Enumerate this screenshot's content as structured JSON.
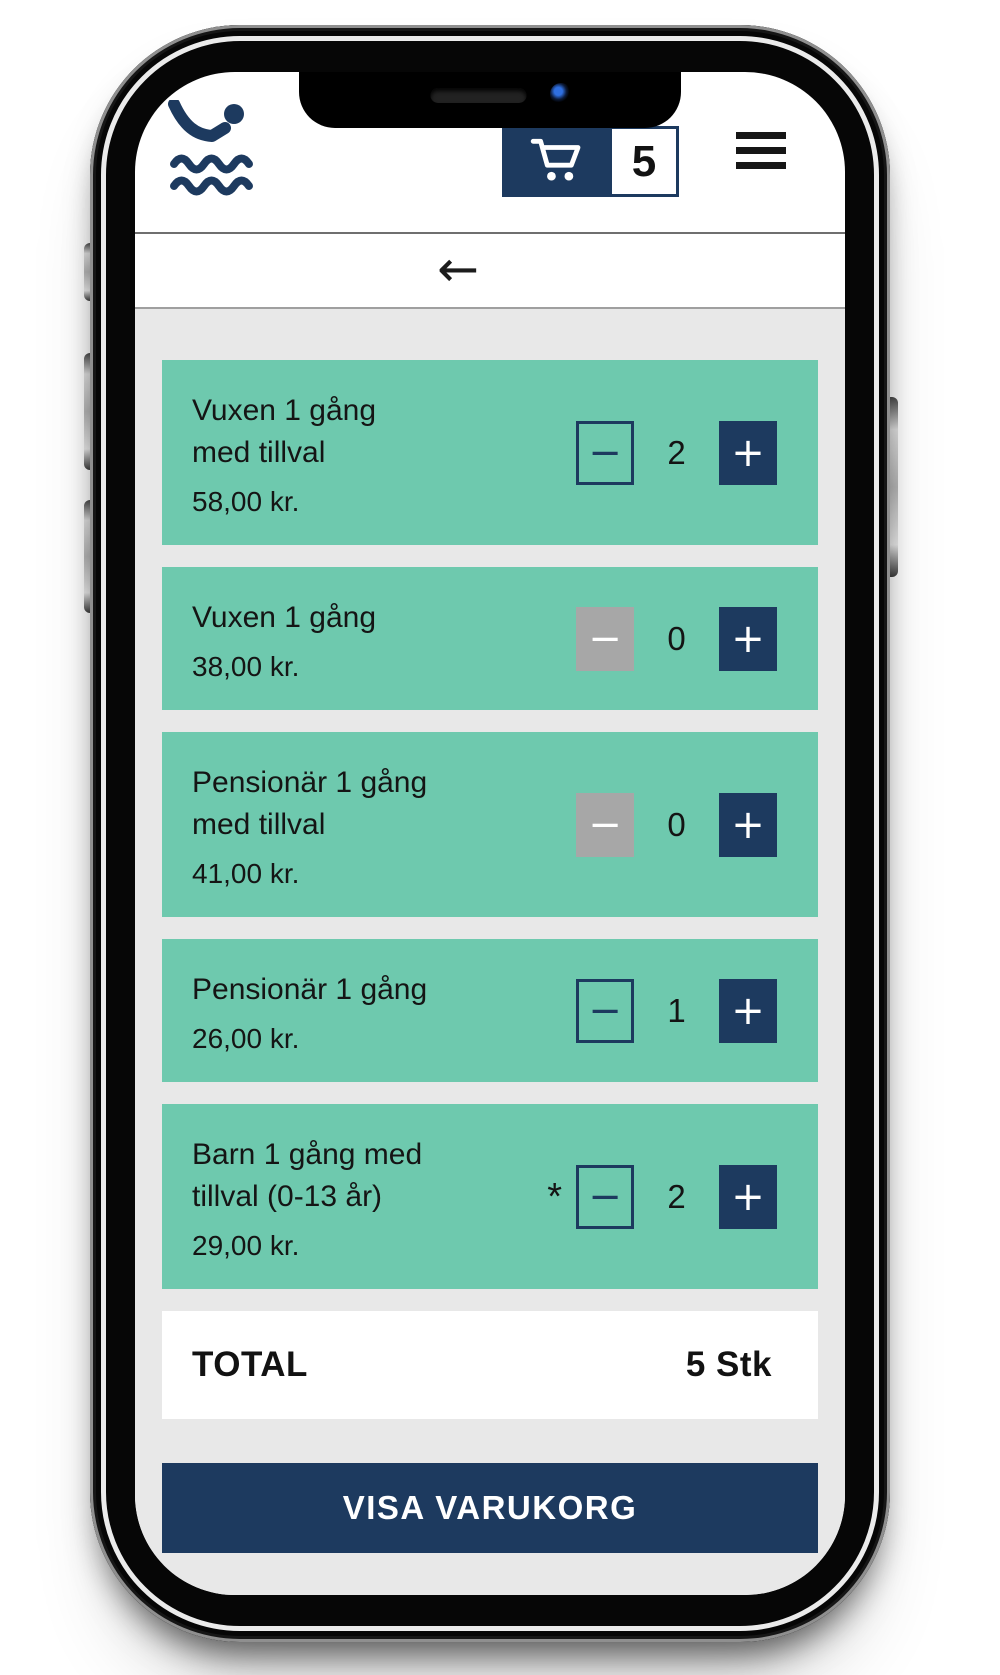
{
  "colors": {
    "navy": "#1d3a5f",
    "teal": "#6ec9ae",
    "screen_bg": "#e8e8e8",
    "disabled_gray": "#a7a7a7"
  },
  "icons": {
    "logo": "swimmer-waves-icon",
    "cart": "cart-icon",
    "menu": "hamburger-icon",
    "back": "back-arrow-icon"
  },
  "header": {
    "cart_count": "5"
  },
  "nav": {
    "back": "←"
  },
  "symbols": {
    "minus": "−",
    "plus": "+"
  },
  "tickets": [
    {
      "title": "Vuxen 1 gång med tillval",
      "price": "58,00 kr.",
      "qty": "2",
      "minus_state": "enabled",
      "note": ""
    },
    {
      "title": "Vuxen 1 gång",
      "price": "38,00 kr.",
      "qty": "0",
      "minus_state": "disabled",
      "note": ""
    },
    {
      "title": "Pensionär 1 gång med tillval",
      "price": "41,00 kr.",
      "qty": "0",
      "minus_state": "disabled",
      "note": ""
    },
    {
      "title": "Pensionär 1 gång",
      "price": "26,00 kr.",
      "qty": "1",
      "minus_state": "enabled",
      "note": ""
    },
    {
      "title": "Barn 1 gång med tillval (0-13 år)",
      "price": "29,00 kr.",
      "qty": "2",
      "minus_state": "enabled",
      "note": "*"
    }
  ],
  "total": {
    "label": "TOTAL",
    "value": "5 Stk"
  },
  "cta": {
    "label": "VISA VARUKORG"
  }
}
